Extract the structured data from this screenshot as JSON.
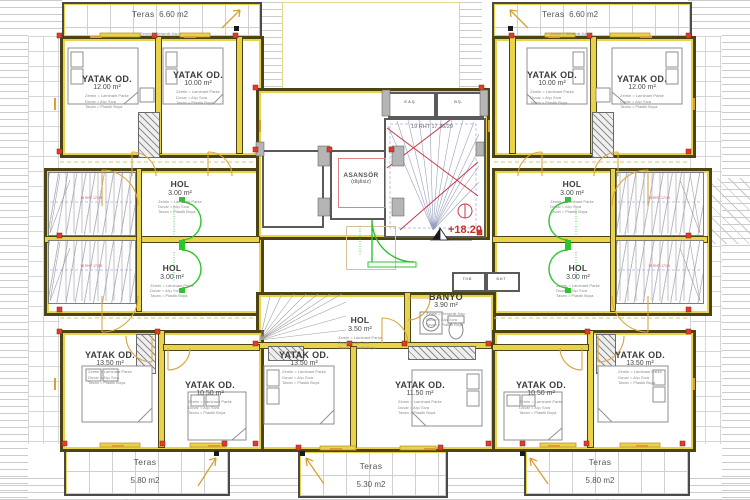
{
  "drawing_type": "floor-plan",
  "colors": {
    "wall_fill": "#e9d34b",
    "wall_line": "#4c4414",
    "column_red": "#e23b28",
    "door_green": "#2cc52c",
    "door_orange": "#d9a63c",
    "stair_red": "#c43a4a",
    "stair_blue": "#7b86c8",
    "tile_line": "#cfcfcf",
    "level_red": "#c23328"
  },
  "bedrooms": {
    "tl_outer": {
      "name": "YATAK OD.",
      "area": "12.00 m²"
    },
    "tl_inner": {
      "name": "YATAK OD.",
      "area": "10.00 m²"
    },
    "tr_inner": {
      "name": "YATAK OD.",
      "area": "10.00 m²"
    },
    "tr_outer": {
      "name": "YATAK OD.",
      "area": "12.00 m²"
    },
    "bl_outer": {
      "name": "YATAK OD.",
      "area": "13.50 m²"
    },
    "bl_inner": {
      "name": "YATAK OD.",
      "area": "10.50 m²"
    },
    "bm_left": {
      "name": "YATAK OD.",
      "area": "13.50 m²"
    },
    "bm_right": {
      "name": "YATAK OD.",
      "area": "11.50 m²"
    },
    "br_inner": {
      "name": "YATAK OD.",
      "area": "10.50 m²"
    },
    "br_outer": {
      "name": "YATAK OD.",
      "area": "13.50 m²"
    }
  },
  "halls": {
    "left_top": {
      "name": "HOL",
      "area": "3.00 m²"
    },
    "left_bottom": {
      "name": "HOL",
      "area": "3.00 m²"
    },
    "right_top": {
      "name": "HOL",
      "area": "3.00 m²"
    },
    "right_bottom": {
      "name": "HOL",
      "area": "3.00 m²"
    },
    "center": {
      "name": "HOL",
      "area": "3.50 m²"
    }
  },
  "bathroom": {
    "name": "BANYO",
    "area": "3.90 m²"
  },
  "elevator": {
    "name": "ASANSÖR",
    "type": "(dişlisiz)"
  },
  "stairs": {
    "main_label": "19 RHT 17.36/29",
    "side_note": "18 RHT 17/28"
  },
  "level_marker": "+18.20",
  "shafts": {
    "left": "E.A.Ş.",
    "right": "B.Ş.",
    "thb": "T.H.B",
    "bht": "B.H.T"
  },
  "terraces": {
    "top_left": {
      "name": "Teras",
      "area": "6.60 m2"
    },
    "top_right": {
      "name": "Teras",
      "area": "6.60 m2"
    },
    "bottom_left": {
      "name": "Teras",
      "area": "5.80 m2"
    },
    "bottom_center": {
      "name": "Teras",
      "area": "5.30 m2"
    },
    "bottom_right": {
      "name": "Teras",
      "area": "5.80 m2"
    }
  },
  "specs": {
    "room": [
      "Zemin = Laminant Parke",
      "Duvar = Alçı Sıva",
      "Tavan = Plastik Boya"
    ],
    "bath": [
      "Zemin = Seramik Kap.",
      "Duvar = Alçı Sıva",
      "Tavan = Plastik Boya"
    ],
    "teras": "Zemin = Seramik Kap."
  }
}
